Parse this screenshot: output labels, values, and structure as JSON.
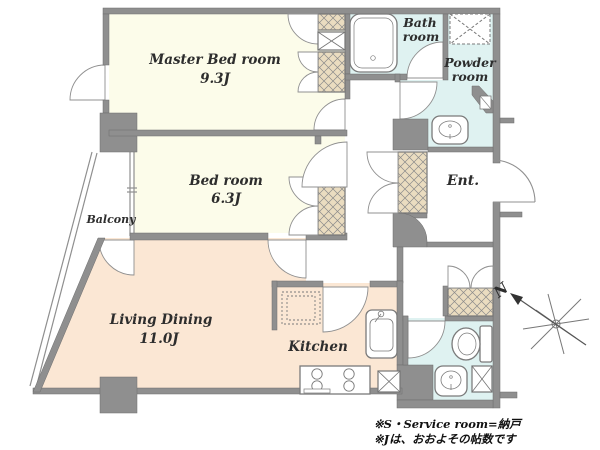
{
  "rooms": {
    "master_bedroom": {
      "name": "Master Bed room",
      "size": "9.3J"
    },
    "bedroom": {
      "name": "Bed room",
      "size": "6.3J"
    },
    "living_dining": {
      "name": "Living Dining",
      "size": "11.0J"
    },
    "kitchen": {
      "name": "Kitchen"
    },
    "bathroom": {
      "line1": "Bath",
      "line2": "room"
    },
    "powder_room": {
      "line1": "Powder",
      "line2": "room"
    },
    "entrance": {
      "name": "Ent."
    },
    "balcony": {
      "name": "Balcony"
    }
  },
  "compass": {
    "north_label": "N"
  },
  "footnotes": {
    "line1": "※S・Service room=納戸",
    "line2": "※Jは、おおよその帖数です"
  },
  "colors": {
    "wall": "#8f8f8f",
    "bedroom_floor": "#FCFCEA",
    "living_floor": "#FBE7D4",
    "wet_area_floor": "#DFF2F1",
    "closet": "#EADCC0"
  }
}
